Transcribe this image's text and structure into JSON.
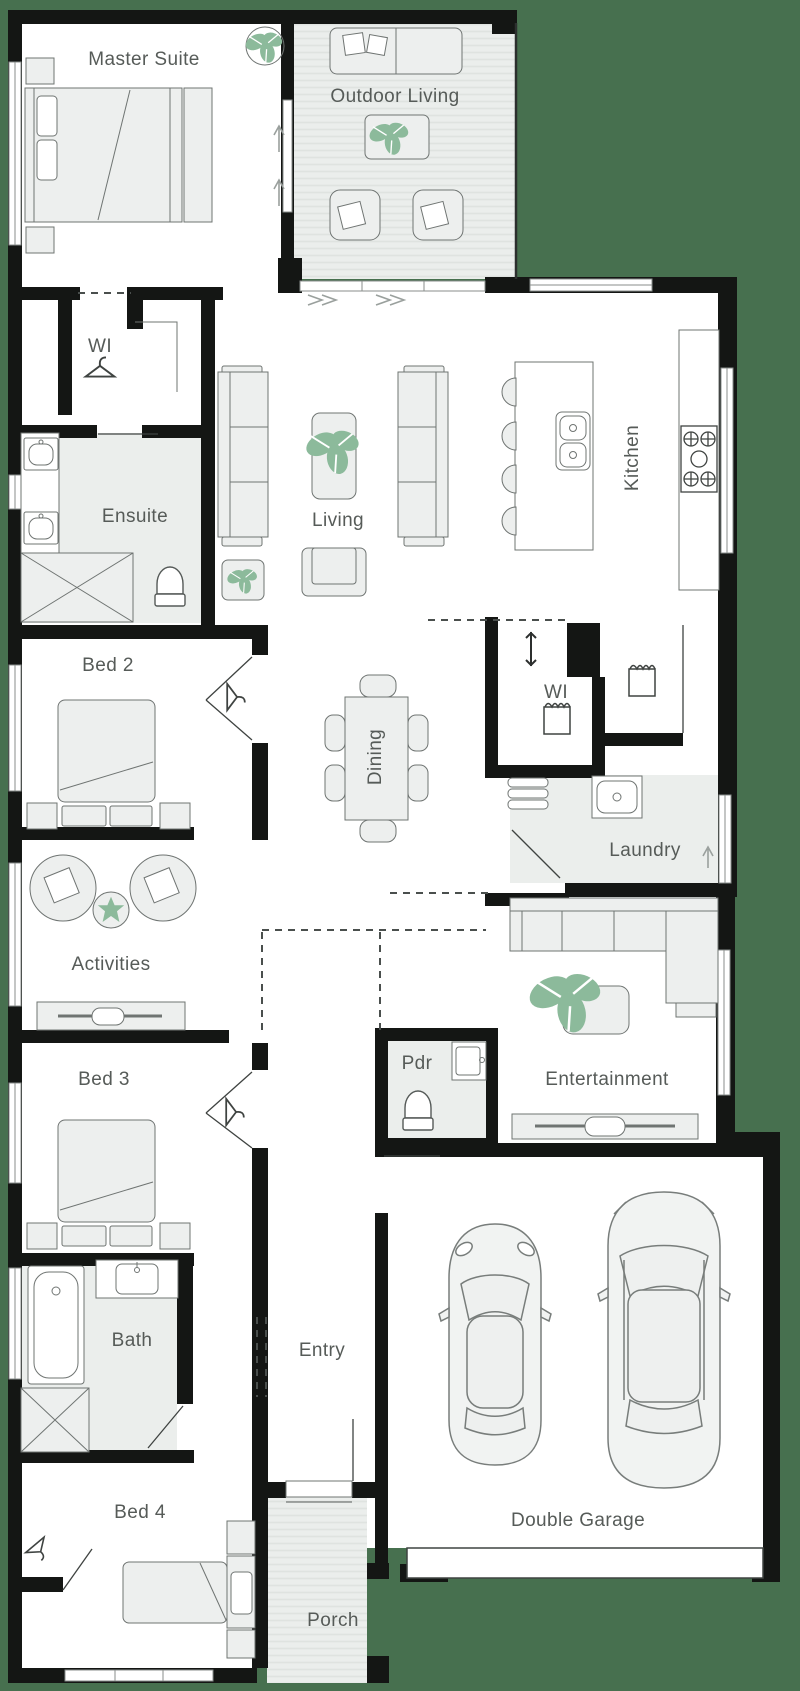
{
  "title": "Single storey home floor plan",
  "colors": {
    "background": "#47704F",
    "wall": "#141614",
    "floor": "#ffffff",
    "wet": "#ebeeec",
    "deck_stripe": "#dfe3e0",
    "furniture_fill": "#edefee",
    "furniture_stroke": "#6f7472",
    "plant": "#8cba9b",
    "label": "#565b58",
    "outline": "#4a4f4d"
  },
  "rooms": {
    "master_suite": {
      "label": "Master Suite"
    },
    "outdoor_living": {
      "label": "Outdoor Living"
    },
    "wi_master": {
      "label": "WI"
    },
    "ensuite": {
      "label": "Ensuite"
    },
    "living": {
      "label": "Living"
    },
    "kitchen": {
      "label": "Kitchen"
    },
    "bed2": {
      "label": "Bed 2"
    },
    "dining": {
      "label": "Dining"
    },
    "wi_pantry": {
      "label": "WI"
    },
    "laundry": {
      "label": "Laundry"
    },
    "activities": {
      "label": "Activities"
    },
    "bed3": {
      "label": "Bed 3"
    },
    "pdr": {
      "label": "Pdr"
    },
    "entertainment": {
      "label": "Entertainment"
    },
    "bath": {
      "label": "Bath"
    },
    "entry": {
      "label": "Entry"
    },
    "bed4": {
      "label": "Bed 4"
    },
    "porch": {
      "label": "Porch"
    },
    "double_garage": {
      "label": "Double Garage"
    }
  }
}
